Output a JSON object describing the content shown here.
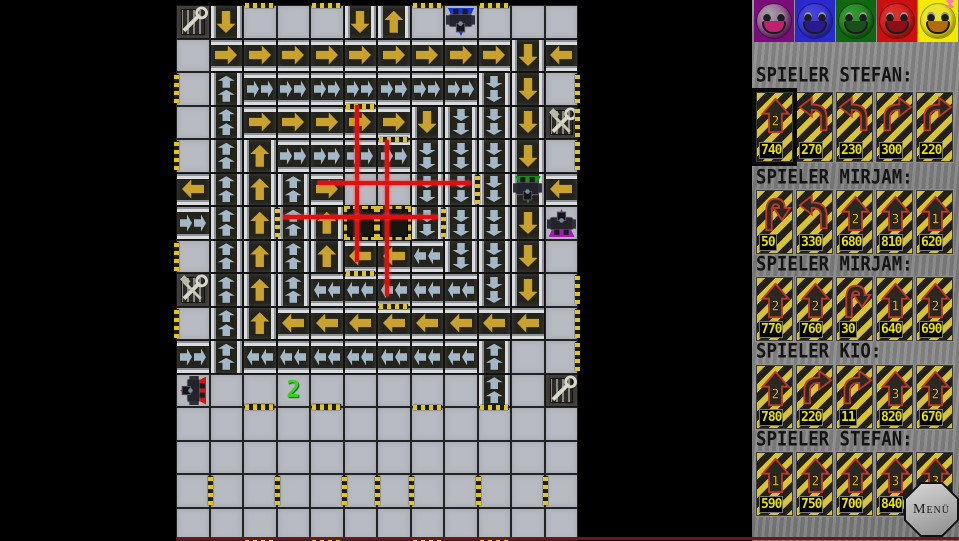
{
  "window": {
    "background": "#000000",
    "bottom_line_color": "#6e1717"
  },
  "board": {
    "cols": 12,
    "rows": 16,
    "tile_px": 33.5,
    "origin_x": 176,
    "origin_y": 5,
    "tile_legend": {
      ".": "plain-floor",
      "Y>": "conveyor-yellow-right",
      "Y<": "conveyor-yellow-left",
      "Y^": "conveyor-yellow-up",
      "Yv": "conveyor-yellow-down",
      "B>": "express-conveyor-right",
      "B<": "express-conveyor-left",
      "B^": "express-conveyor-up",
      "Bv": "express-conveyor-down",
      "P": "pit-hazard",
      "T1": "repair-wrench-grate",
      "T2": "repair-hammer-wrench-grate",
      "T3": "repair-hammer-wrench-grate",
      "T4": "repair-wrench-grate",
      "SB": "start-marker-blue"
    },
    "tiles": [
      "T1 Yv . . . Yv Y^ . SB . . .",
      ". Y> Y> Y> Y> Y> Y> Y> Y> Y> Yv Y<",
      ". B^ B> B> B> B> B> B> B> Bv Yv .",
      ". B^ Y> Y> Y> Y> Y> Yv Bv Bv Yv T2",
      ". B^ Y^ B> B> B> B> Bv Bv Bv Yv .",
      "Y< B^ Y^ B^ Y> . . Bv Bv Bv Yv Y<",
      "B> B^ Y^ B^ Y^ P P Bv Bv Bv Yv .",
      ". B^ Y^ B^ Y^ Y< Y< B< Bv Bv Yv .",
      "T3 B^ Y^ B^ B< B< B< B< B< Bv Yv .",
      ". B^ Y^ Y< Y< Y< Y< Y< Y< Y< Y< .",
      "B> B^ B< B< B< B< B< B< B< B^ . .",
      ". . . . . . . . . B^ . T4",
      ". . . . . . . . . . . .",
      ". . . . . . . . . . . .",
      ". . . . . . . . . . . .",
      ". . . . . . . . . . . ."
    ],
    "walls": [
      {
        "c": 2,
        "r": 0,
        "side": "top"
      },
      {
        "c": 4,
        "r": 0,
        "side": "top"
      },
      {
        "c": 7,
        "r": 0,
        "side": "top"
      },
      {
        "c": 9,
        "r": 0,
        "side": "top"
      },
      {
        "c": 0,
        "r": 2,
        "side": "left"
      },
      {
        "c": 0,
        "r": 4,
        "side": "left"
      },
      {
        "c": 0,
        "r": 7,
        "side": "left"
      },
      {
        "c": 0,
        "r": 9,
        "side": "left"
      },
      {
        "c": 11,
        "r": 2,
        "side": "right"
      },
      {
        "c": 11,
        "r": 3,
        "side": "right"
      },
      {
        "c": 11,
        "r": 4,
        "side": "right"
      },
      {
        "c": 11,
        "r": 8,
        "side": "right"
      },
      {
        "c": 11,
        "r": 9,
        "side": "right"
      },
      {
        "c": 11,
        "r": 10,
        "side": "right"
      },
      {
        "c": 5,
        "r": 3,
        "side": "top"
      },
      {
        "c": 6,
        "r": 4,
        "side": "top"
      },
      {
        "c": 5,
        "r": 8,
        "side": "top"
      },
      {
        "c": 6,
        "r": 8,
        "side": "bottom"
      },
      {
        "c": 3,
        "r": 6,
        "side": "left"
      },
      {
        "c": 7,
        "r": 6,
        "side": "right"
      },
      {
        "c": 8,
        "r": 5,
        "side": "right"
      },
      {
        "c": 2,
        "r": 11,
        "side": "bottom"
      },
      {
        "c": 4,
        "r": 11,
        "side": "bottom"
      },
      {
        "c": 2,
        "r": 12,
        "side": "top"
      },
      {
        "c": 4,
        "r": 12,
        "side": "top"
      },
      {
        "c": 7,
        "r": 12,
        "side": "top"
      },
      {
        "c": 9,
        "r": 12,
        "side": "top"
      },
      {
        "c": 1,
        "r": 14,
        "side": "left"
      },
      {
        "c": 3,
        "r": 14,
        "side": "left"
      },
      {
        "c": 5,
        "r": 14,
        "side": "left"
      },
      {
        "c": 6,
        "r": 14,
        "side": "left"
      },
      {
        "c": 7,
        "r": 14,
        "side": "left"
      },
      {
        "c": 9,
        "r": 14,
        "side": "left"
      },
      {
        "c": 11,
        "r": 14,
        "side": "left"
      },
      {
        "c": 2,
        "r": 15,
        "side": "bottom"
      },
      {
        "c": 4,
        "r": 15,
        "side": "bottom"
      },
      {
        "c": 7,
        "r": 15,
        "side": "bottom"
      },
      {
        "c": 9,
        "r": 15,
        "side": "bottom"
      }
    ],
    "lasers": [
      {
        "type": "v",
        "x": 181,
        "y1": 100,
        "y2": 257
      },
      {
        "type": "v",
        "x": 211,
        "y1": 135,
        "y2": 291
      },
      {
        "type": "h",
        "y": 178,
        "x1": 142,
        "x2": 295
      },
      {
        "type": "h",
        "y": 212,
        "x1": 107,
        "x2": 262
      }
    ],
    "laser_color": "#e01010",
    "robots": [
      {
        "name": "blue-robot",
        "c": 8,
        "r": 0,
        "triangle": "#1535d8",
        "triangle_dir": "down",
        "rotate": 180
      },
      {
        "name": "green-robot",
        "c": 10,
        "r": 5,
        "triangle": "#1e8a1e",
        "triangle_dir": "down",
        "rotate": 180
      },
      {
        "name": "purple-robot",
        "c": 11,
        "r": 6,
        "triangle": "#b012c0",
        "triangle_dir": "up",
        "rotate": 0
      },
      {
        "name": "red-robot",
        "c": 0,
        "r": 11,
        "triangle": "#e01010",
        "triangle_dir": "left",
        "rotate": 270
      }
    ],
    "markers": [
      {
        "c": 3,
        "r": 11,
        "text": "2",
        "color": "#3bd41b"
      }
    ],
    "colors": {
      "floor": "#b7bac0",
      "conveyor": "#24241c",
      "arrow_yellow": "#c9a22e",
      "arrow_blue": "#a3b8c6",
      "hazard": "#d8c020"
    }
  },
  "panel": {
    "smileys": [
      {
        "name": "purple",
        "bg": "#7a0d7a",
        "face": "#ababab",
        "mouth": "#c02070"
      },
      {
        "name": "blue",
        "bg": "#2a2acc",
        "face": "#4747dd",
        "mouth": "#2a1a90"
      },
      {
        "name": "green",
        "bg": "#116611",
        "face": "#33a033",
        "mouth": "#17501a"
      },
      {
        "name": "red",
        "bg": "#cc0f0f",
        "face": "#dd3333",
        "mouth": "#8a0f18"
      },
      {
        "name": "yellow",
        "bg": "#f2ea00",
        "face": "#e8e23a",
        "mouth": "#b06a10",
        "accessory": "bow"
      }
    ],
    "sections": [
      {
        "header": "SPIELER STEFAN:",
        "cards": [
          {
            "type": "move",
            "steps": "2",
            "value": "740",
            "selected": true
          },
          {
            "type": "turn-left",
            "value": "270"
          },
          {
            "type": "turn-left",
            "value": "230"
          },
          {
            "type": "turn-right",
            "value": "300"
          },
          {
            "type": "turn-right",
            "value": "220"
          }
        ]
      },
      {
        "header": "SPIELER MIRJAM:",
        "cards": [
          {
            "type": "uturn",
            "value": "50"
          },
          {
            "type": "turn-left",
            "value": "330"
          },
          {
            "type": "move",
            "steps": "2",
            "value": "680"
          },
          {
            "type": "move",
            "steps": "3",
            "value": "810"
          },
          {
            "type": "move",
            "steps": "1",
            "value": "620"
          }
        ]
      },
      {
        "header": "SPIELER MIRJAM:",
        "cards": [
          {
            "type": "move",
            "steps": "2",
            "value": "770"
          },
          {
            "type": "move",
            "steps": "2",
            "value": "760"
          },
          {
            "type": "uturn",
            "value": "30"
          },
          {
            "type": "move",
            "steps": "1",
            "value": "640"
          },
          {
            "type": "move",
            "steps": "2",
            "value": "690"
          }
        ]
      },
      {
        "header": "SPIELER KIO:",
        "cards": [
          {
            "type": "move",
            "steps": "2",
            "value": "780"
          },
          {
            "type": "turn-right",
            "value": "220"
          },
          {
            "type": "turn-right",
            "value": "11"
          },
          {
            "type": "move",
            "steps": "3",
            "value": "820"
          },
          {
            "type": "move",
            "steps": "2",
            "value": "670"
          }
        ]
      },
      {
        "header": "SPIELER STEFAN:",
        "cards": [
          {
            "type": "move",
            "steps": "1",
            "value": "590"
          },
          {
            "type": "move",
            "steps": "2",
            "value": "750"
          },
          {
            "type": "move",
            "steps": "2",
            "value": "700"
          },
          {
            "type": "move",
            "steps": "3",
            "value": "840"
          },
          {
            "type": "move",
            "steps": "3",
            "value": ""
          }
        ]
      }
    ],
    "card_colors": {
      "stripe_yellow": "#d8c332",
      "stripe_black": "#23201a",
      "arrow_fill": "#2b2822",
      "arrow_outline": "#c03828",
      "value_text": "#e8e000"
    },
    "menu_button": {
      "label": "Menü"
    }
  }
}
